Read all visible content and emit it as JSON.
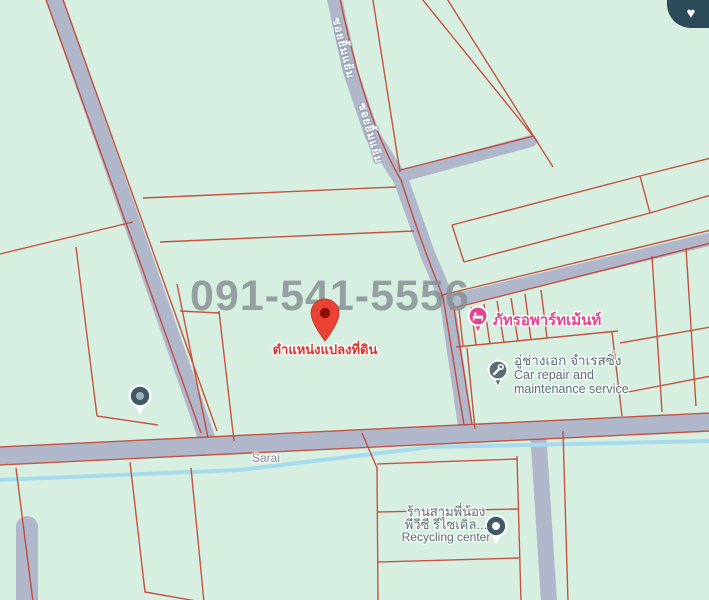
{
  "map": {
    "watermark_phone": "091-541-5556",
    "marker": {
      "label": "ตำแหน่งแปลงที่ดิน"
    },
    "roads": {
      "soi_label_1": "ซอยยิ้มแย้ม",
      "soi_label_2": "ซอยยิ้มแย้ม",
      "canal_label": "Sarai"
    },
    "pois": {
      "apartment": {
        "name": "ภัทรอพาร์ทเม้นท์",
        "icon": "bed-lodging-icon"
      },
      "car_repair": {
        "line1_th": "อู่ช่างเอก จำเรสซิ่ง",
        "line2_en": "Car repair and",
        "line3_en": "maintenance service",
        "icon": "wrench-icon"
      },
      "recycling": {
        "line1_th": "ร้านสามพี่น้อง",
        "line2_th": "พีวีซี รีไซเคิล...",
        "line3_en": "Recycling center",
        "icon": "recycling-icon"
      },
      "unnamed_place": {
        "icon": "place-dot-icon"
      }
    },
    "favorite_button": {
      "icon": "heart-icon",
      "glyph": "♥"
    },
    "colors": {
      "land": "#d7efe0",
      "road": "#b0b7cb",
      "water": "#a6dbee",
      "parcel_line": "#c2412f",
      "watermark_gray": "#868f93",
      "marker_red": "#ea4335",
      "poi_pink": "#e5458f",
      "poi_gray": "#5d6d74",
      "favorite_bg": "#2c4a57"
    }
  }
}
